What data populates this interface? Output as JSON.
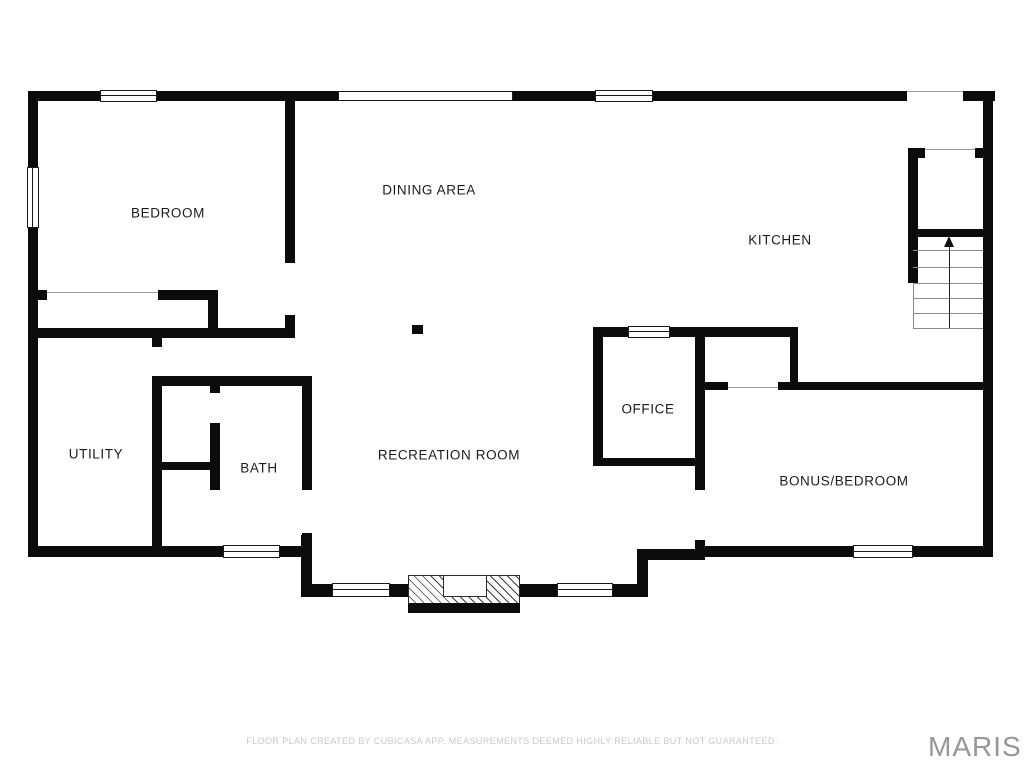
{
  "page": {
    "background": "#ffffff"
  },
  "colors": {
    "wall": "#0b0b0b",
    "window_frame": "#1a1a1a",
    "door_line": "#9a9a9a",
    "tread_line": "#8c8c8c",
    "label_text": "#1c1c1c",
    "footer_text": "#c9c9c9",
    "watermark_text": "#96969c"
  },
  "rooms": [
    {
      "id": "bedroom",
      "label": "BEDROOM",
      "x": 168,
      "y": 213
    },
    {
      "id": "dining-area",
      "label": "DINING AREA",
      "x": 429,
      "y": 190
    },
    {
      "id": "kitchen",
      "label": "KITCHEN",
      "x": 780,
      "y": 240
    },
    {
      "id": "utility",
      "label": "UTILITY",
      "x": 96,
      "y": 454
    },
    {
      "id": "bath",
      "label": "BATH",
      "x": 259,
      "y": 468
    },
    {
      "id": "office",
      "label": "OFFICE",
      "x": 648,
      "y": 409
    },
    {
      "id": "recreation-room",
      "label": "RECREATION ROOM",
      "x": 449,
      "y": 455
    },
    {
      "id": "bonus-bedroom",
      "label": "BONUS/BEDROOM",
      "x": 844,
      "y": 481
    }
  ],
  "geometry": {
    "walls": [
      [
        28,
        91,
        72,
        10
      ],
      [
        157,
        91,
        181,
        10
      ],
      [
        513,
        91,
        82,
        10
      ],
      [
        653,
        91,
        254,
        10
      ],
      [
        963,
        91,
        32,
        10
      ],
      [
        28,
        91,
        10,
        76
      ],
      [
        28,
        228,
        10,
        329
      ],
      [
        983,
        91,
        10,
        466
      ],
      [
        28,
        546,
        195,
        11
      ],
      [
        280,
        546,
        32,
        11
      ],
      [
        695,
        546,
        158,
        11
      ],
      [
        913,
        546,
        80,
        11
      ],
      [
        285,
        101,
        10,
        162
      ],
      [
        285,
        315,
        10,
        23
      ],
      [
        38,
        290,
        9,
        10
      ],
      [
        158,
        290,
        60,
        10
      ],
      [
        208,
        290,
        10,
        48
      ],
      [
        28,
        328,
        267,
        10
      ],
      [
        152,
        338,
        10,
        9
      ],
      [
        152,
        376,
        10,
        170
      ],
      [
        152,
        376,
        160,
        10
      ],
      [
        210,
        386,
        10,
        7
      ],
      [
        210,
        423,
        10,
        67
      ],
      [
        158,
        462,
        54,
        8
      ],
      [
        302,
        376,
        10,
        114
      ],
      [
        302,
        533,
        10,
        13
      ],
      [
        301,
        535,
        11,
        62
      ],
      [
        301,
        584,
        31,
        13
      ],
      [
        390,
        584,
        28,
        13
      ],
      [
        518,
        584,
        39,
        13
      ],
      [
        613,
        584,
        35,
        13
      ],
      [
        637,
        550,
        11,
        47
      ],
      [
        637,
        549,
        68,
        11
      ],
      [
        695,
        327,
        10,
        163
      ],
      [
        695,
        540,
        10,
        17
      ],
      [
        593,
        327,
        35,
        10
      ],
      [
        670,
        327,
        128,
        10
      ],
      [
        593,
        327,
        10,
        139
      ],
      [
        593,
        458,
        112,
        8
      ],
      [
        790,
        327,
        8,
        63
      ],
      [
        695,
        382,
        33,
        8
      ],
      [
        778,
        382,
        215,
        8
      ],
      [
        908,
        148,
        10,
        135
      ],
      [
        908,
        148,
        17,
        10
      ],
      [
        975,
        148,
        12,
        10
      ],
      [
        915,
        229,
        70,
        8
      ]
    ],
    "windows": [
      {
        "x": 100,
        "y": 90,
        "w": 57,
        "h": 12,
        "o": "h",
        "center": true
      },
      {
        "x": 338,
        "y": 91,
        "w": 175,
        "h": 10,
        "o": "h",
        "center": false
      },
      {
        "x": 595,
        "y": 90,
        "w": 58,
        "h": 12,
        "o": "h",
        "center": true
      },
      {
        "x": 27,
        "y": 167,
        "w": 12,
        "h": 61,
        "o": "v",
        "center": true
      },
      {
        "x": 628,
        "y": 326,
        "w": 42,
        "h": 12,
        "o": "h",
        "center": true
      },
      {
        "x": 223,
        "y": 545,
        "w": 57,
        "h": 13,
        "o": "h",
        "center": true
      },
      {
        "x": 332,
        "y": 583,
        "w": 58,
        "h": 14,
        "o": "h",
        "center": true
      },
      {
        "x": 557,
        "y": 583,
        "w": 56,
        "h": 14,
        "o": "h",
        "center": true
      },
      {
        "x": 853,
        "y": 545,
        "w": 60,
        "h": 13,
        "o": "h",
        "center": true
      }
    ],
    "opening_lines": [
      [
        907,
        91,
        56,
        1
      ],
      [
        925,
        149,
        50,
        1
      ],
      [
        47,
        292,
        111,
        1
      ],
      [
        728,
        387,
        50,
        1
      ]
    ],
    "stair_treads": [
      [
        913,
        250,
        70,
        1
      ],
      [
        913,
        267,
        70,
        1
      ],
      [
        913,
        283,
        70,
        1
      ],
      [
        913,
        298,
        70,
        1
      ],
      [
        913,
        313,
        70,
        1
      ],
      [
        913,
        328,
        70,
        1
      ],
      [
        913,
        283,
        1,
        45
      ]
    ],
    "stair_arrow": {
      "shaft_x": 949,
      "shaft_y": 246,
      "shaft_h": 82,
      "head_x": 944,
      "head_y": 236
    },
    "column": {
      "x": 412,
      "y": 325,
      "w": 11,
      "h": 9
    },
    "fireplace": {
      "hatch": [
        408,
        575,
        112,
        30
      ],
      "band": [
        408,
        603,
        112,
        10
      ],
      "firebox": [
        443,
        575,
        44,
        22
      ]
    }
  },
  "footer": {
    "disclaimer": "FLOOR PLAN CREATED BY CUBICASA APP. MEASUREMENTS DEEMED HIGHLY RELIABLE BUT NOT GUARANTEED."
  },
  "watermark": {
    "text": "MARIS"
  }
}
